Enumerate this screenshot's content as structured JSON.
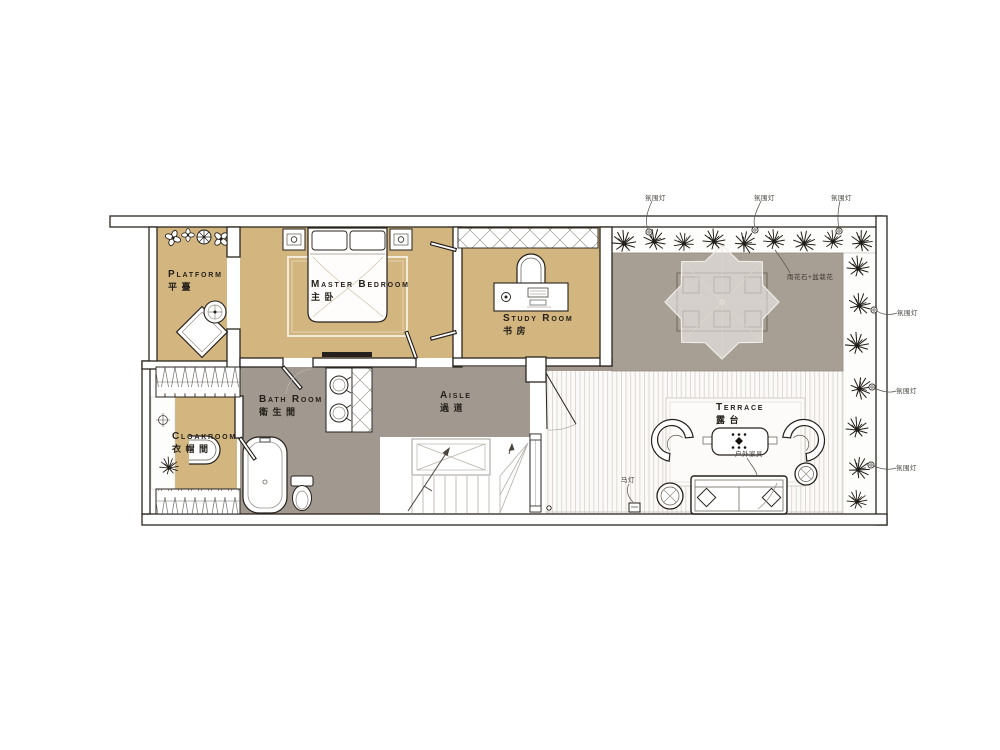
{
  "colors": {
    "wall": "#2b2620",
    "tan": "#d3b67f",
    "gray": "#a19990",
    "stone": "#a89f94",
    "deckline": "#d7d2cb",
    "ink": "#211d18",
    "leader": "#5a554e"
  },
  "rooms": [
    {
      "key": "platform",
      "en": "Platform",
      "zh": "平臺"
    },
    {
      "key": "master_bedroom",
      "en": "Master Bedroom",
      "zh": "主卧"
    },
    {
      "key": "study_room",
      "en": "Study Room",
      "zh": "书房"
    },
    {
      "key": "bath_room",
      "en": "Bath Room",
      "zh": "衛生間"
    },
    {
      "key": "cloakroom",
      "en": "Cloakroom",
      "zh": "衣帽間"
    },
    {
      "key": "aisle",
      "en": "Aisle",
      "zh": "過道"
    },
    {
      "key": "terrace",
      "en": "Terrace",
      "zh": "露台"
    }
  ],
  "annotations": {
    "ambient_light": "氛围灯",
    "pebbles_and_potted_flowers": "雨花石+盆栽花",
    "outdoor_furniture": "户外家具",
    "storm_lantern": "马灯"
  }
}
